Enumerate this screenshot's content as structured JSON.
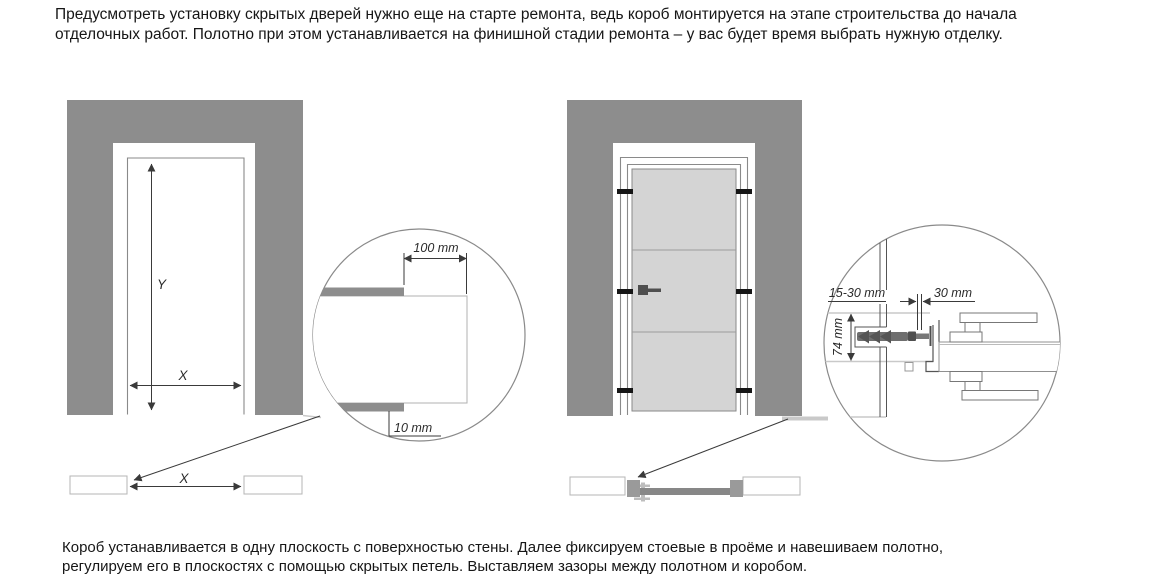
{
  "intro": {
    "lines": [
      "Предусмотреть установку скрытых дверей нужно еще на старте ремонта, ведь короб монтируется на этапе строительства до начала",
      "отделочных работ. Полотно при этом устанавливается на финишной стадии ремонта – у вас будет время выбрать нужную отделку."
    ]
  },
  "footer": {
    "lines": [
      "Короб устанавливается в одну плоскость с поверхностью стены. Далее фиксируем стоевые в проёме и навешиваем полотно,",
      "регулируем его в плоскостях с помощью скрытых петель. Выставляем зазоры между полотном и коробом."
    ]
  },
  "left_figure": {
    "opening_height_label": "Y",
    "opening_width_label": "X",
    "plan_width_label": "X",
    "detail": {
      "wall_offset": "100 mm",
      "finish_thickness": "10 mm"
    }
  },
  "right_figure": {
    "detail": {
      "mounting_gap": "15-30 mm",
      "frame_width": "30 mm",
      "frame_depth": "74 mm"
    }
  },
  "colors": {
    "wall": "#8d8d8d",
    "door_leaf": "#d4d4d4",
    "fitting_black": "#161616",
    "dowel_gray": "#6e6e6e",
    "plan_leaf_gray": "#878787",
    "plan_jamb_gray": "#9a9a9a"
  }
}
